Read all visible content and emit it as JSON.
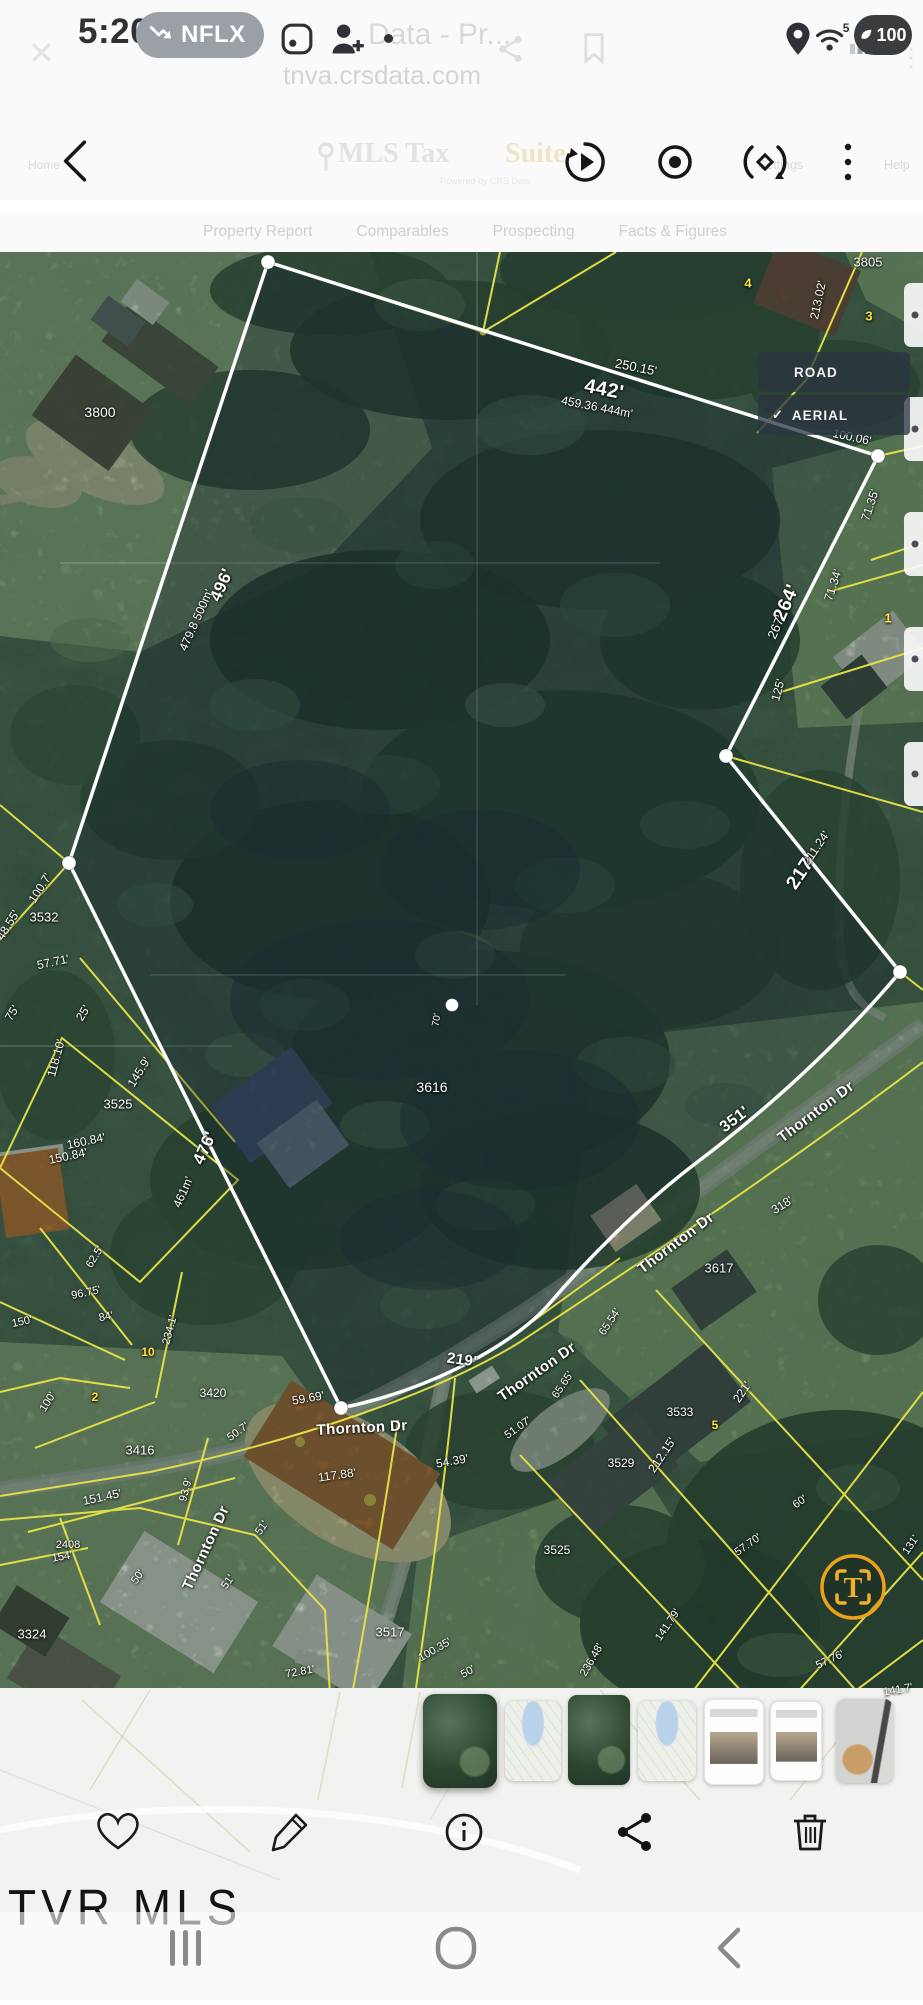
{
  "status_bar": {
    "time": "5:20",
    "notification_label": "NFLX",
    "battery": "100",
    "wifi_label": "5",
    "ghost_title": "Data - Pr...",
    "ghost_url": "tnva.crsdata.com"
  },
  "toolbar": {
    "ghost_home": "Home",
    "ghost_brand": "MLS Tax",
    "ghost_brand_suffix": "Suite",
    "ghost_powered": "Powered by CRS Data",
    "ghost_settings": "Settings",
    "ghost_help": "Help"
  },
  "tabs": [
    "Property Report",
    "Comparables",
    "Prospecting",
    "Facts & Figures"
  ],
  "map": {
    "layer_control": {
      "options": [
        {
          "label": "ROAD",
          "selected": false
        },
        {
          "label": "AERIAL",
          "selected": true
        }
      ],
      "check_glyph": "✓"
    },
    "road_name": "Thornton Dr",
    "subject_parcel": "3616",
    "fab_glyph": "T",
    "colors": {
      "parcel_line": "#e8e446",
      "boundary": "#ffffff",
      "fab": "#f0a81e"
    },
    "labels": [
      {
        "t": "3805",
        "x": 868,
        "y": 262,
        "r": 0,
        "s": 13
      },
      {
        "t": "213.02'",
        "x": 818,
        "y": 300,
        "r": -78,
        "s": 12
      },
      {
        "t": "4",
        "x": 748,
        "y": 283,
        "r": 0,
        "s": 13,
        "c": "y"
      },
      {
        "t": "3",
        "x": 869,
        "y": 316,
        "r": 0,
        "s": 13,
        "c": "y"
      },
      {
        "t": "250.15'",
        "x": 636,
        "y": 367,
        "r": 11,
        "s": 13
      },
      {
        "t": "442'",
        "x": 604,
        "y": 390,
        "r": 11,
        "s": 20,
        "b": 1
      },
      {
        "t": "459.36 444m'",
        "x": 597,
        "y": 407,
        "r": 11,
        "s": 12
      },
      {
        "t": "3800",
        "x": 100,
        "y": 412,
        "r": 0,
        "s": 14
      },
      {
        "t": "100.06'",
        "x": 852,
        "y": 437,
        "r": 12,
        "s": 12
      },
      {
        "t": "71.35'",
        "x": 870,
        "y": 505,
        "r": -72,
        "s": 12
      },
      {
        "t": "71.34'",
        "x": 833,
        "y": 585,
        "r": -72,
        "s": 12
      },
      {
        "t": "264'",
        "x": 787,
        "y": 603,
        "r": -66,
        "s": 19,
        "b": 1
      },
      {
        "t": "267'",
        "x": 776,
        "y": 627,
        "r": -66,
        "s": 13
      },
      {
        "t": "125'",
        "x": 778,
        "y": 690,
        "r": -75,
        "s": 12
      },
      {
        "t": "496'",
        "x": 222,
        "y": 585,
        "r": -66,
        "s": 17,
        "b": 1
      },
      {
        "t": "479.8 500m'",
        "x": 196,
        "y": 620,
        "r": -66,
        "s": 12
      },
      {
        "t": "211.24'",
        "x": 816,
        "y": 848,
        "r": -56,
        "s": 12
      },
      {
        "t": "217'",
        "x": 802,
        "y": 872,
        "r": -56,
        "s": 19,
        "b": 1
      },
      {
        "t": "1",
        "x": 888,
        "y": 618,
        "r": 0,
        "s": 13,
        "c": "y"
      },
      {
        "t": "3532",
        "x": 44,
        "y": 917,
        "r": 0,
        "s": 13
      },
      {
        "t": "100.7'",
        "x": 40,
        "y": 888,
        "r": -58,
        "s": 12
      },
      {
        "t": "48.55'",
        "x": 8,
        "y": 925,
        "r": -58,
        "s": 12
      },
      {
        "t": "57.71'",
        "x": 53,
        "y": 962,
        "r": -12,
        "s": 12
      },
      {
        "t": "75'",
        "x": 12,
        "y": 1013,
        "r": -58,
        "s": 12
      },
      {
        "t": "25'",
        "x": 83,
        "y": 1013,
        "r": -58,
        "s": 12
      },
      {
        "t": "118.10'",
        "x": 56,
        "y": 1058,
        "r": -75,
        "s": 12
      },
      {
        "t": "145.9'",
        "x": 139,
        "y": 1072,
        "r": -58,
        "s": 12
      },
      {
        "t": "3525",
        "x": 118,
        "y": 1104,
        "r": 0,
        "s": 13
      },
      {
        "t": "160.84'",
        "x": 86,
        "y": 1141,
        "r": -12,
        "s": 12
      },
      {
        "t": "150.84'",
        "x": 68,
        "y": 1156,
        "r": -12,
        "s": 12
      },
      {
        "t": "3616",
        "x": 432,
        "y": 1087,
        "r": 0,
        "s": 14
      },
      {
        "t": "476'",
        "x": 205,
        "y": 1148,
        "r": -66,
        "s": 17,
        "b": 1
      },
      {
        "t": "461m'",
        "x": 183,
        "y": 1192,
        "r": -66,
        "s": 12
      },
      {
        "t": "70'",
        "x": 437,
        "y": 1020,
        "r": -80,
        "s": 10
      },
      {
        "t": "62.5'",
        "x": 95,
        "y": 1257,
        "r": -58,
        "s": 11
      },
      {
        "t": "96.75'",
        "x": 86,
        "y": 1293,
        "r": -12,
        "s": 11
      },
      {
        "t": "84'",
        "x": 106,
        "y": 1317,
        "r": -12,
        "s": 11
      },
      {
        "t": "234.1'",
        "x": 170,
        "y": 1330,
        "r": -75,
        "s": 11
      },
      {
        "t": "150'",
        "x": 22,
        "y": 1322,
        "r": -12,
        "s": 11
      },
      {
        "t": "351'",
        "x": 735,
        "y": 1120,
        "r": -37,
        "s": 16,
        "b": 1
      },
      {
        "t": "Thornton Dr",
        "x": 816,
        "y": 1112,
        "r": -37,
        "s": 15,
        "b": 1
      },
      {
        "t": "318'",
        "x": 782,
        "y": 1205,
        "r": -32,
        "s": 12
      },
      {
        "t": "Thornton Dr",
        "x": 676,
        "y": 1243,
        "r": -37,
        "s": 15,
        "b": 1
      },
      {
        "t": "3617",
        "x": 719,
        "y": 1268,
        "r": 0,
        "s": 13
      },
      {
        "t": "219'",
        "x": 462,
        "y": 1360,
        "r": 8,
        "s": 15,
        "b": 1
      },
      {
        "t": "Thornton Dr",
        "x": 537,
        "y": 1372,
        "r": -35,
        "s": 15,
        "b": 1
      },
      {
        "t": "Thornton Dr",
        "x": 362,
        "y": 1428,
        "r": -3,
        "s": 15,
        "b": 1
      },
      {
        "t": "59.69'",
        "x": 308,
        "y": 1398,
        "r": -10,
        "s": 12
      },
      {
        "t": "65.65'",
        "x": 563,
        "y": 1385,
        "r": -56,
        "s": 11
      },
      {
        "t": "65.54'",
        "x": 610,
        "y": 1322,
        "r": -56,
        "s": 11
      },
      {
        "t": "51.07'",
        "x": 518,
        "y": 1428,
        "r": -35,
        "s": 11
      },
      {
        "t": "54.39'",
        "x": 452,
        "y": 1461,
        "r": -10,
        "s": 12
      },
      {
        "t": "117.88'",
        "x": 337,
        "y": 1475,
        "r": -8,
        "s": 12
      },
      {
        "t": "3420",
        "x": 213,
        "y": 1393,
        "r": 0,
        "s": 12
      },
      {
        "t": "2",
        "x": 95,
        "y": 1397,
        "r": 0,
        "s": 12,
        "c": "y"
      },
      {
        "t": "10",
        "x": 148,
        "y": 1352,
        "r": 0,
        "s": 12,
        "c": "y"
      },
      {
        "t": "100'",
        "x": 48,
        "y": 1402,
        "r": -58,
        "s": 11
      },
      {
        "t": "50.7'",
        "x": 238,
        "y": 1432,
        "r": -35,
        "s": 11
      },
      {
        "t": "3416",
        "x": 140,
        "y": 1450,
        "r": 0,
        "s": 13
      },
      {
        "t": "151.45'",
        "x": 102,
        "y": 1497,
        "r": -12,
        "s": 12
      },
      {
        "t": "93.9'",
        "x": 186,
        "y": 1490,
        "r": -75,
        "s": 11
      },
      {
        "t": "Thornton Dr",
        "x": 206,
        "y": 1548,
        "r": -65,
        "s": 15,
        "b": 1
      },
      {
        "t": "51'",
        "x": 262,
        "y": 1528,
        "r": -55,
        "s": 11
      },
      {
        "t": "51'",
        "x": 228,
        "y": 1582,
        "r": -55,
        "s": 11
      },
      {
        "t": "2408",
        "x": 68,
        "y": 1545,
        "r": 0,
        "s": 11
      },
      {
        "t": "154'",
        "x": 62,
        "y": 1557,
        "r": -10,
        "s": 11
      },
      {
        "t": "50'",
        "x": 138,
        "y": 1577,
        "r": -55,
        "s": 11
      },
      {
        "t": "3324",
        "x": 32,
        "y": 1634,
        "r": 0,
        "s": 13
      },
      {
        "t": "3533",
        "x": 680,
        "y": 1412,
        "r": 0,
        "s": 12
      },
      {
        "t": "5",
        "x": 715,
        "y": 1425,
        "r": 0,
        "s": 12,
        "c": "y"
      },
      {
        "t": "3529",
        "x": 621,
        "y": 1463,
        "r": 0,
        "s": 12
      },
      {
        "t": "212.15'",
        "x": 662,
        "y": 1455,
        "r": -56,
        "s": 12
      },
      {
        "t": "221'",
        "x": 742,
        "y": 1392,
        "r": -56,
        "s": 12
      },
      {
        "t": "60'",
        "x": 800,
        "y": 1502,
        "r": -35,
        "s": 11
      },
      {
        "t": "57.70'",
        "x": 748,
        "y": 1545,
        "r": -35,
        "s": 11
      },
      {
        "t": "131'",
        "x": 911,
        "y": 1545,
        "r": -56,
        "s": 11
      },
      {
        "t": "141.79'",
        "x": 668,
        "y": 1625,
        "r": -56,
        "s": 11
      },
      {
        "t": "3525",
        "x": 557,
        "y": 1550,
        "r": 0,
        "s": 12
      },
      {
        "t": "3517",
        "x": 390,
        "y": 1632,
        "r": 0,
        "s": 13
      },
      {
        "t": "236.48'",
        "x": 592,
        "y": 1660,
        "r": -60,
        "s": 11
      },
      {
        "t": "72.81'",
        "x": 300,
        "y": 1672,
        "r": -10,
        "s": 11
      },
      {
        "t": "100.35'",
        "x": 435,
        "y": 1650,
        "r": -30,
        "s": 11
      },
      {
        "t": "50'",
        "x": 468,
        "y": 1672,
        "r": -30,
        "s": 11
      },
      {
        "t": "57.76'",
        "x": 830,
        "y": 1660,
        "r": -25,
        "s": 11
      },
      {
        "t": "141.7'",
        "x": 898,
        "y": 1690,
        "r": -10,
        "s": 11
      }
    ]
  },
  "thumbnails": [
    {
      "type": "aerial",
      "selected": true,
      "x": 423,
      "y": 1694,
      "w": 74,
      "h": 94
    },
    {
      "type": "roadmap",
      "selected": false,
      "x": 505,
      "y": 1701,
      "w": 56,
      "h": 80
    },
    {
      "type": "aerial",
      "selected": false,
      "x": 568,
      "y": 1695,
      "w": 62,
      "h": 90
    },
    {
      "type": "roadmap",
      "selected": false,
      "x": 638,
      "y": 1701,
      "w": 58,
      "h": 80
    },
    {
      "type": "document",
      "selected": false,
      "x": 704,
      "y": 1699,
      "w": 58,
      "h": 84
    },
    {
      "type": "document",
      "selected": false,
      "x": 770,
      "y": 1701,
      "w": 50,
      "h": 78
    },
    {
      "type": "photo",
      "selected": false,
      "x": 836,
      "y": 1699,
      "w": 57,
      "h": 84
    }
  ],
  "watermark": "TVR MLS"
}
